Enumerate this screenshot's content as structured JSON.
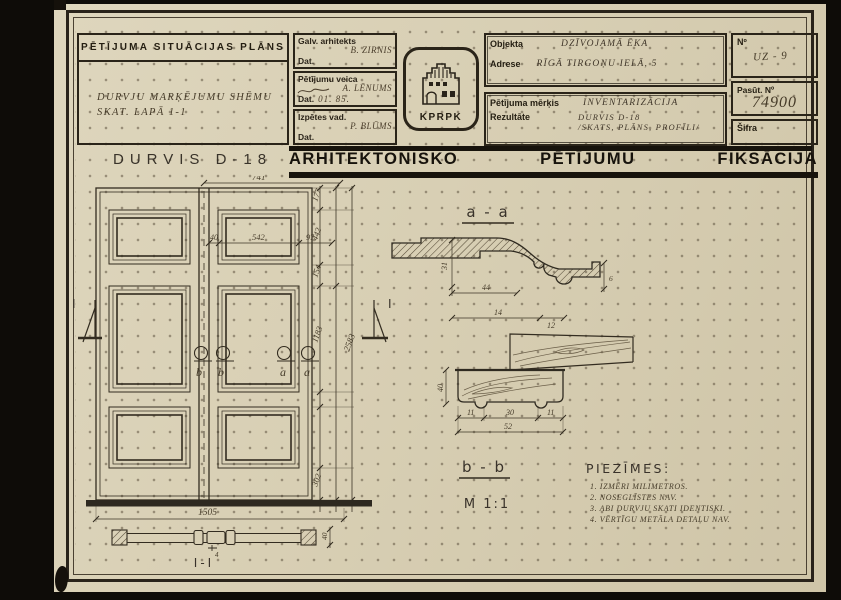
{
  "colors": {
    "paper": "#d8cfb4",
    "ink": "#2b251b",
    "band": "#17130c",
    "pencil": "#463d2c"
  },
  "header": {
    "situation": {
      "title": "PĒTĪJUMA SITUĀCIJAS PLĀNS",
      "note_line1": "DURVJU MARĶĒJUMU SHĒMU",
      "note_line2": "SKAT. LAPĀ 1-1"
    },
    "signatures": [
      {
        "role": "Galv. arhitekts",
        "name": "B. ZIRNIS",
        "date_label": "Dat.",
        "date": ""
      },
      {
        "role": "Pētījumu veica",
        "name": "A. LĒNUMS",
        "date_label": "Dat.",
        "date": "01. 85."
      },
      {
        "role": "Izpētes vad.",
        "name": "P. BLŪMS",
        "date_label": "Dat.",
        "date": ""
      }
    ],
    "logo_text": "KPRPK",
    "object_label": "Objekta",
    "object_value": "DZĪVOJAMĀ ĒKA",
    "address_label": "Adrese",
    "address_value": "RĪGĀ TIRGOŅU IELĀ, 5",
    "purpose_label": "Pētījuma mērķis",
    "purpose_value": "INVENTARIZĀCIJA",
    "result_label": "Rezultāte",
    "result_line1": "DURVIS D-18",
    "result_line2": "/SKATS, PLĀNS, PROFĪLI/",
    "number_label": "Nº",
    "number_value": "UZ - 9",
    "order_label": "Pasūt. Nº",
    "order_value": "74900",
    "cipher_label": "Šifra",
    "cipher_value": ""
  },
  "title_row": {
    "drawing_title": "DURVIS D-18",
    "band": [
      "ARHITEKTONISKO",
      "PĒTĪJUMU",
      "FIKSĀCIJA"
    ]
  },
  "drawing": {
    "elevation": {
      "dim_top_width": "741",
      "dim_panel": [
        "40",
        "542",
        "97"
      ],
      "dim_heights": [
        "177",
        "442",
        "154",
        "1183",
        "302"
      ],
      "dim_total_height": "2583",
      "dim_bottom_width": "1505",
      "plan_label": "I-I",
      "plan_dim_small": "4",
      "plan_dim_side": "40",
      "mark_section_vertical": "I",
      "mark_b": "b",
      "mark_a": "a"
    },
    "section_aa": {
      "label": "a - a",
      "dim_vertical": "31",
      "dim_mid": "44",
      "dim_bottom": "14",
      "dim_small": "12",
      "dim_right": "6"
    },
    "section_bb": {
      "label": "b - b",
      "scale": "M 1:1",
      "dim_left": "40",
      "dims_bottom": [
        "11",
        "30",
        "11"
      ],
      "dim_total": "52"
    },
    "notes": {
      "title": "PIEZĪMES:",
      "items": [
        "1. IZMĒRI MILIMETROS.",
        "2. NOSEGLĪSTES NAV.",
        "3. ABI DURVJU SKATI IDENTISKI.",
        "4. VĒRTĪGU METĀLA DETAĻU NAV."
      ]
    }
  }
}
